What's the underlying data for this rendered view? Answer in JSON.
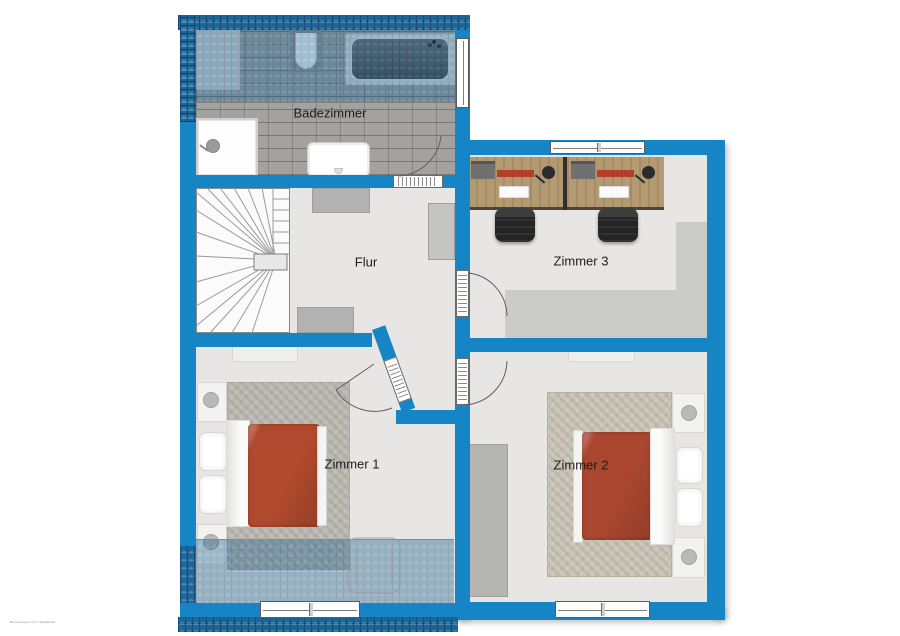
{
  "plan": {
    "type": "floor-plan-upper-storey",
    "rooms": [
      {
        "id": "badezimmer",
        "label": "Badezimmer",
        "furniture": [
          "bathtub",
          "toilet",
          "shower",
          "sink",
          "cabinet"
        ]
      },
      {
        "id": "flur",
        "label": "Flur",
        "furniture": [
          "winder-stairs",
          "sideboard",
          "sideboard",
          "wardrobe"
        ]
      },
      {
        "id": "zimmer3",
        "label": "Zimmer 3",
        "furniture": [
          "desk",
          "desk",
          "office-chair",
          "office-chair",
          "desk-lamp",
          "desk-lamp",
          "rug"
        ]
      },
      {
        "id": "zimmer1",
        "label": "Zimmer 1",
        "furniture": [
          "double-bed",
          "nightstand",
          "nightstand",
          "rug",
          "wall-shelf",
          "armchair-outline"
        ]
      },
      {
        "id": "zimmer2",
        "label": "Zimmer 2",
        "furniture": [
          "double-bed",
          "nightstand",
          "nightstand",
          "rug",
          "wardrobe",
          "wall-shelf"
        ]
      }
    ],
    "fine_print": "Bemessung nicht maßstäblich",
    "colors": {
      "wall": "#1585c6",
      "roof_shingle": "#1d6597",
      "floor": "#e7e6e4",
      "bath_tile": "#a3a2a1",
      "rug_gray": "#bbb8b0",
      "rug_beige": "#c8c3b4",
      "bed_red": "#b04a2e",
      "desk_wood": "#b49a72",
      "background": "#ffffff"
    }
  }
}
